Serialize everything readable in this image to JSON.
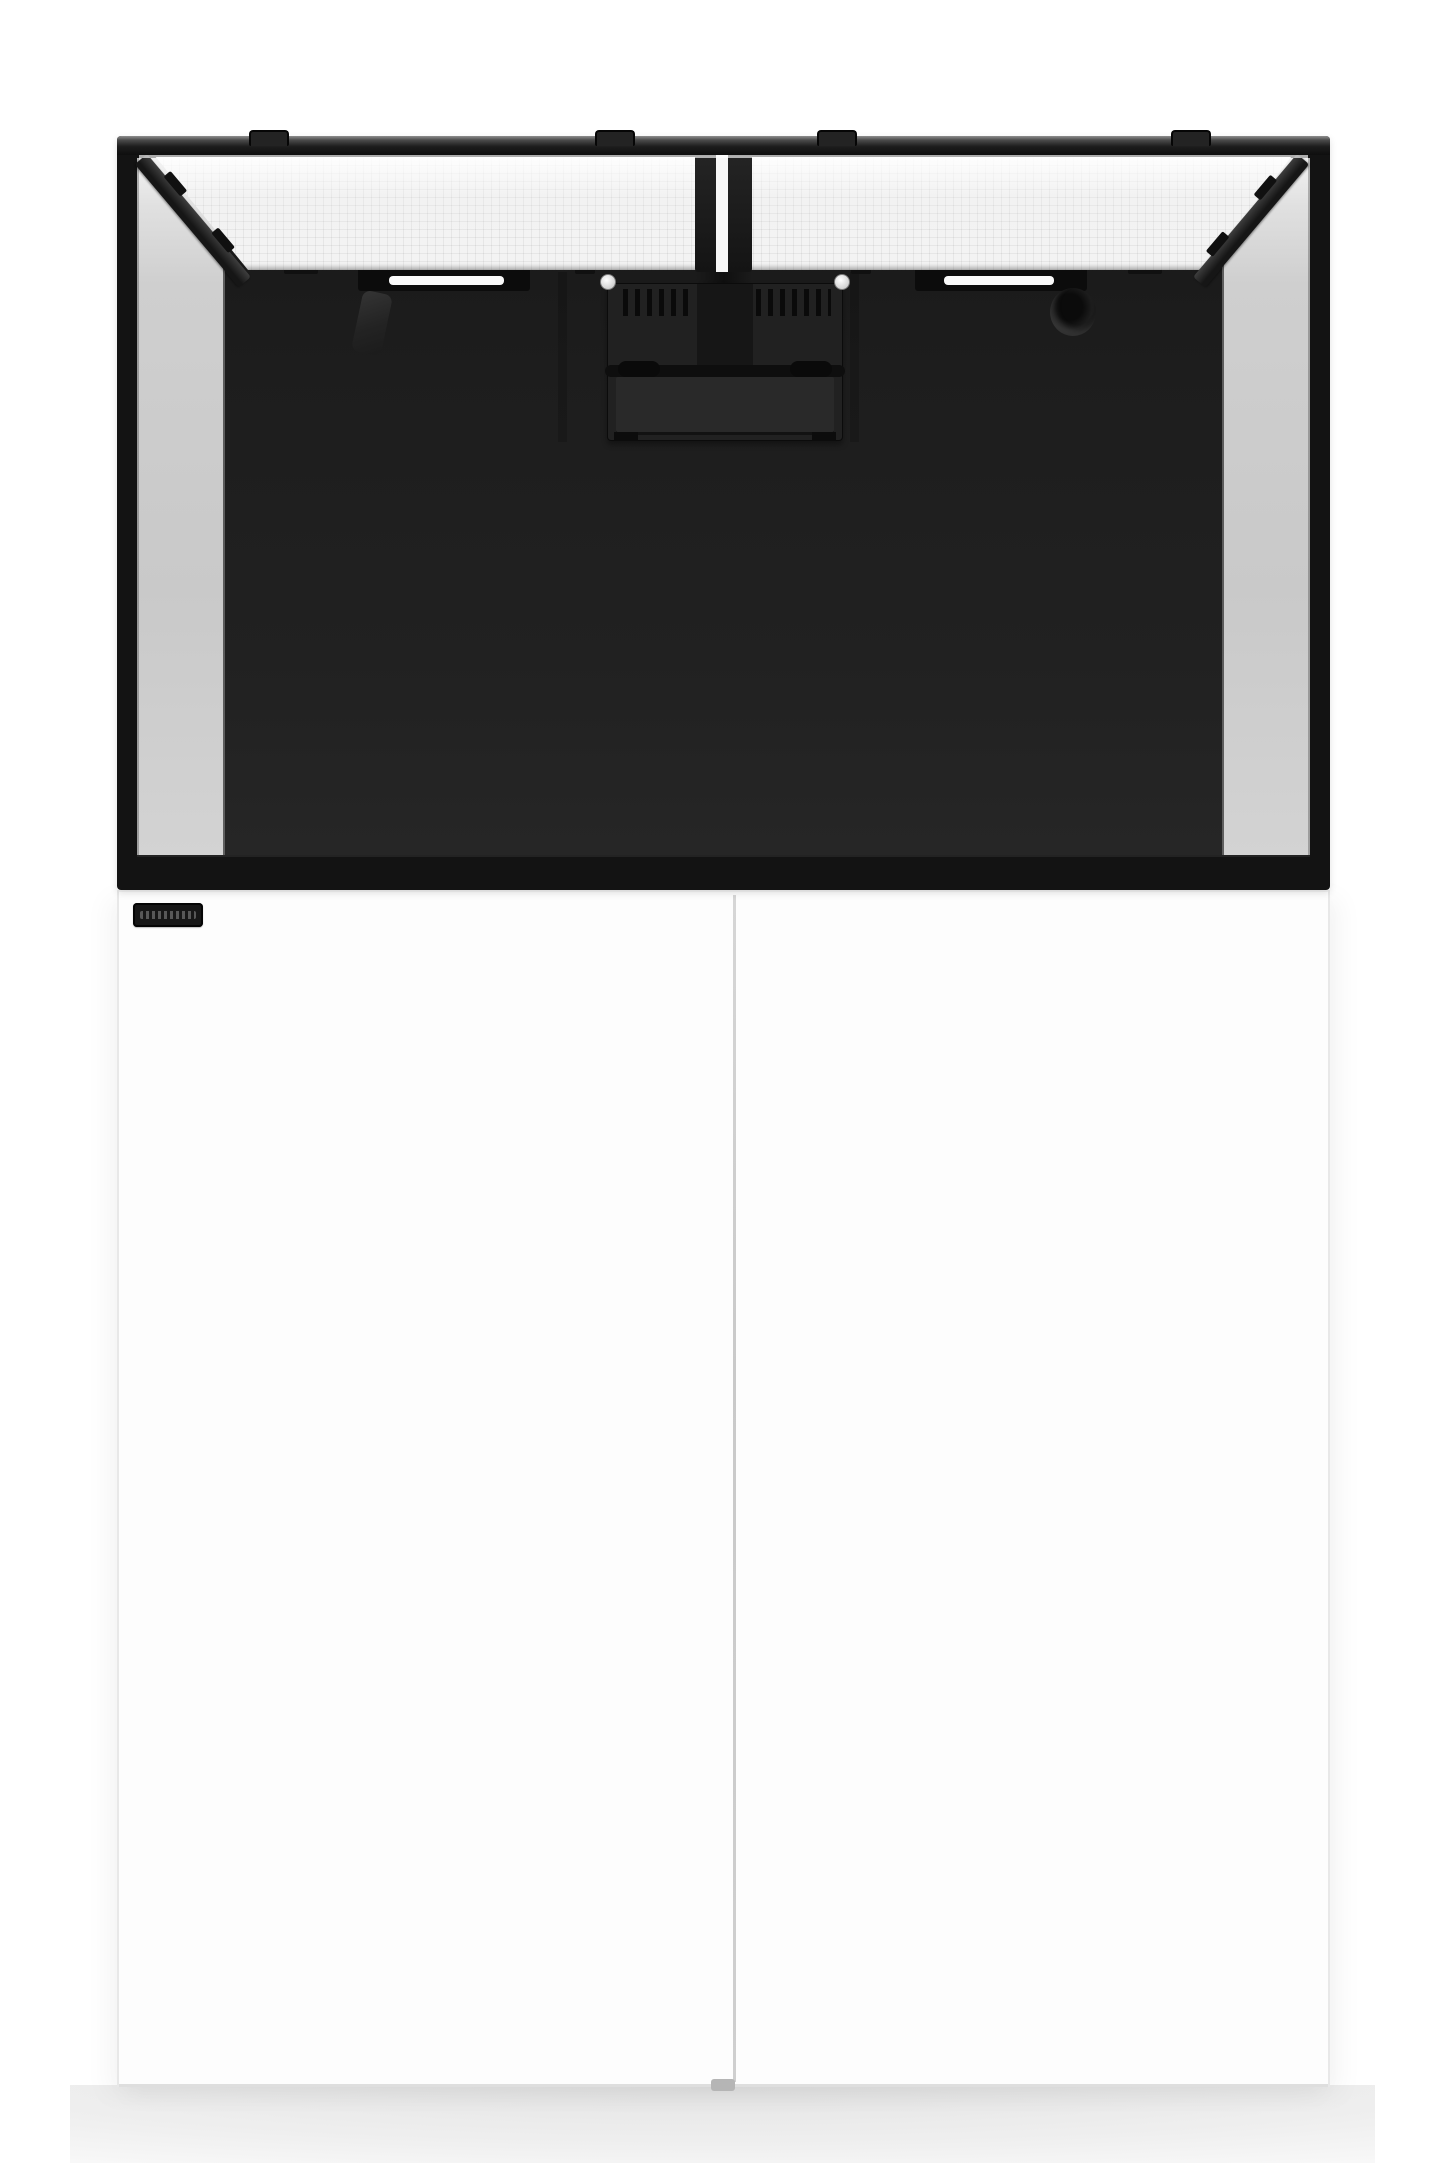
{
  "meta": {
    "type": "product-image",
    "description": "Rimless reef aquarium with black frame, two white mesh screen lids propped open, dark interior back panel, center overflow box with weir teeth, sitting on a white two-door cabinet stand with a small black brand badge"
  },
  "colors": {
    "background": "#ffffff",
    "frame": "#131313",
    "rim_top": "#8f8f8f",
    "interior_dark": "#1d1d1d",
    "interior_light": "#262626",
    "glass": "#c9c9c9",
    "glass_light": "#f3f3f3",
    "mesh": "#f3f3f3",
    "slot_white": "#fafafa",
    "equipment": "#212121",
    "equipment_dark": "#0b0b0b",
    "cabinet": "#fdfdfd",
    "cabinet_edge": "#e8e8e8",
    "seam": "#c9c9c9",
    "badge": "#171717",
    "floor_shadow": "#e4e4e4"
  },
  "parts": {
    "stage": "aquarium product photo",
    "tank": "aquarium tank with black frame",
    "lid_left": "left mesh screen lid",
    "lid_right": "right mesh screen lid",
    "overflow": "center overflow box with weir teeth",
    "glass_left": "left side glass panel",
    "glass_right": "right side glass panel",
    "cabinet": "white cabinet stand",
    "door_seam": "cabinet door seam",
    "badge": "brand badge plate"
  }
}
